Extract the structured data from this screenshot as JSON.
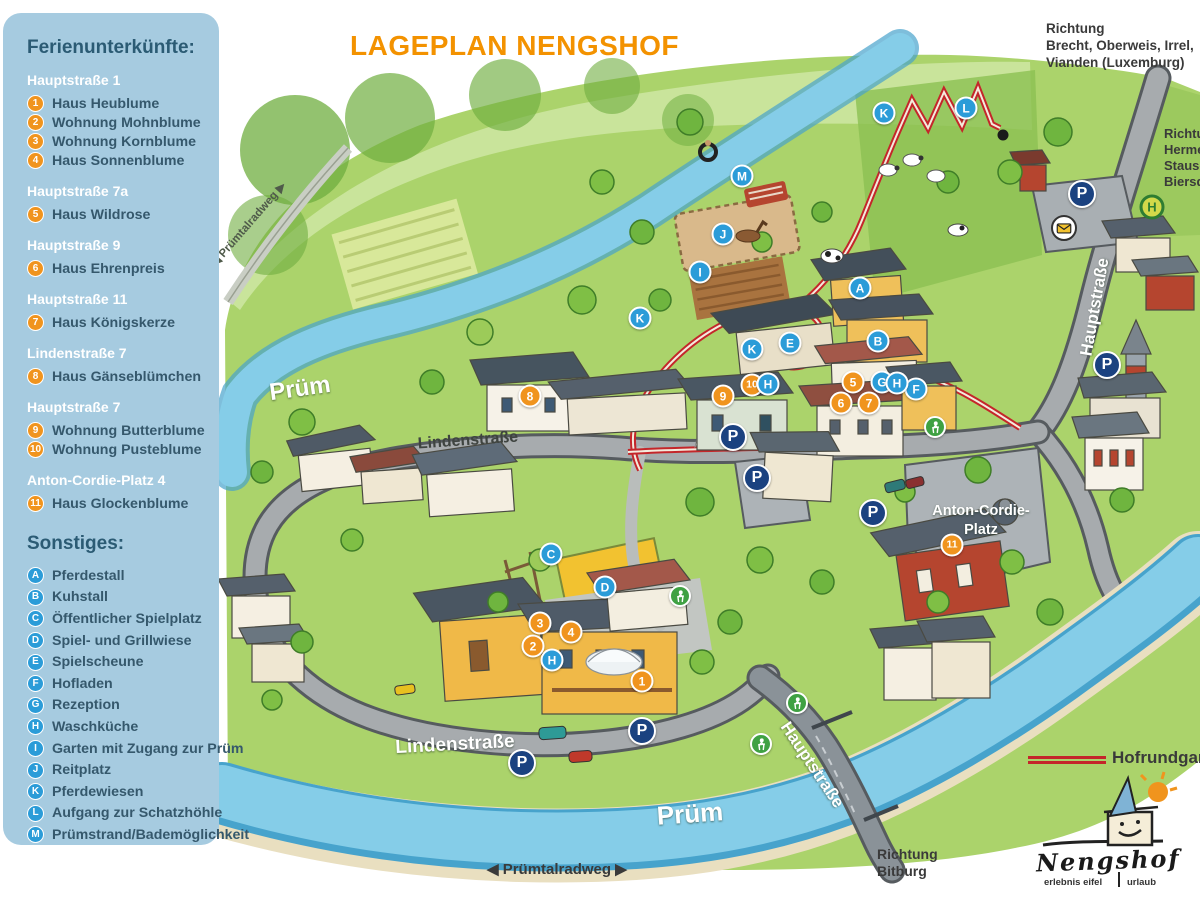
{
  "title": "LAGEPLAN NENGSHOF",
  "sidebar": {
    "title": "Ferienunterkünfte:",
    "groups": [
      {
        "street": "Hauptstraße 1",
        "items": [
          {
            "num": "1",
            "label": "Haus Heublume"
          },
          {
            "num": "2",
            "label": "Wohnung Mohnblume"
          },
          {
            "num": "3",
            "label": "Wohnung Kornblume"
          },
          {
            "num": "4",
            "label": "Haus Sonnenblume"
          }
        ]
      },
      {
        "street": "Hauptstraße 7a",
        "items": [
          {
            "num": "5",
            "label": "Haus Wildrose"
          }
        ]
      },
      {
        "street": "Hauptstraße 9",
        "items": [
          {
            "num": "6",
            "label": "Haus Ehrenpreis"
          }
        ]
      },
      {
        "street": "Hauptstraße 11",
        "items": [
          {
            "num": "7",
            "label": "Haus Königskerze"
          }
        ]
      },
      {
        "street": "Lindenstraße 7",
        "items": [
          {
            "num": "8",
            "label": "Haus Gänseblümchen"
          }
        ]
      },
      {
        "street": "Hauptstraße 7",
        "items": [
          {
            "num": "9",
            "label": "Wohnung Butterblume"
          },
          {
            "num": "10",
            "label": "Wohnung Pusteblume"
          }
        ]
      },
      {
        "street": "Anton-Cordie-Platz 4",
        "items": [
          {
            "num": "11",
            "label": "Haus Glockenblume"
          }
        ]
      }
    ],
    "other_title": "Sonstiges:",
    "others": [
      {
        "letter": "A",
        "label": "Pferdestall"
      },
      {
        "letter": "B",
        "label": "Kuhstall"
      },
      {
        "letter": "C",
        "label": "Öffentlicher Spielplatz"
      },
      {
        "letter": "D",
        "label": "Spiel- und Grillwiese"
      },
      {
        "letter": "E",
        "label": "Spielscheune"
      },
      {
        "letter": "F",
        "label": "Hofladen"
      },
      {
        "letter": "G",
        "label": "Rezeption"
      },
      {
        "letter": "H",
        "label": "Waschküche"
      },
      {
        "letter": "I",
        "label": "Garten mit Zugang zur Prüm"
      },
      {
        "letter": "J",
        "label": "Reitplatz"
      },
      {
        "letter": "K",
        "label": "Pferdewiesen"
      },
      {
        "letter": "L",
        "label": "Aufgang zur Schatzhöhle"
      },
      {
        "letter": "M",
        "label": "Prümstrand/Bademöglichkeit"
      }
    ]
  },
  "map": {
    "texts": {
      "direction_top_right": [
        "Richtung",
        "Brecht, Oberweis, Irrel,",
        "Vianden (Luxemburg)"
      ],
      "direction_right": [
        "Richtung",
        "Hermesdorf,",
        "Stausee,",
        "Biersdorf"
      ],
      "direction_bottom": [
        "Richtung",
        "Bitburg"
      ],
      "bike_path_bottom": "◀ Prümtalradweg ▶",
      "route_legend": "Hofrundgang",
      "logo_name": "Nengshof",
      "logo_tag_left": "erlebnis eifel",
      "logo_tag_right": "urlaub"
    },
    "labels": [
      {
        "text": "Prüm",
        "x": 300,
        "y": 389,
        "size": 24,
        "color": "#FFFFFF",
        "rotate": -8,
        "shadow": true
      },
      {
        "text": "Prüm",
        "x": 690,
        "y": 814,
        "size": 26,
        "color": "#FFFFFF",
        "rotate": -4,
        "shadow": true
      },
      {
        "text": "Lindenstraße",
        "x": 468,
        "y": 441,
        "size": 16,
        "color": "#3F4440",
        "rotate": -4,
        "shadow": false
      },
      {
        "text": "Lindenstraße",
        "x": 455,
        "y": 745,
        "size": 19,
        "color": "#FFFFFF",
        "rotate": -3,
        "shadow": true
      },
      {
        "text": "Hauptstraße",
        "x": 1095,
        "y": 307,
        "size": 17,
        "color": "#FFFFFF",
        "rotate": -80,
        "shadow": true
      },
      {
        "text": "Hauptstraße",
        "x": 812,
        "y": 765,
        "size": 17,
        "color": "#FFFFFF",
        "rotate": 56,
        "shadow": true
      },
      {
        "text": "Anton-Cordie-",
        "x": 981,
        "y": 511,
        "size": 14.5,
        "color": "#FFFFFF",
        "rotate": 0,
        "shadow": true
      },
      {
        "text": "Platz",
        "x": 981,
        "y": 530,
        "size": 14.5,
        "color": "#FFFFFF",
        "rotate": 0,
        "shadow": true
      },
      {
        "text": "◀ Prümtalradweg ▶",
        "x": 248,
        "y": 224,
        "size": 11.5,
        "color": "#4F5A4A",
        "rotate": -49,
        "shadow": false
      }
    ],
    "markers": [
      {
        "type": "num",
        "label": "1",
        "x": 642,
        "y": 681
      },
      {
        "type": "num",
        "label": "2",
        "x": 533,
        "y": 646
      },
      {
        "type": "num",
        "label": "3",
        "x": 540,
        "y": 623
      },
      {
        "type": "num",
        "label": "4",
        "x": 571,
        "y": 632
      },
      {
        "type": "num",
        "label": "5",
        "x": 853,
        "y": 382
      },
      {
        "type": "num",
        "label": "6",
        "x": 841,
        "y": 403
      },
      {
        "type": "num",
        "label": "7",
        "x": 869,
        "y": 403
      },
      {
        "type": "num",
        "label": "8",
        "x": 530,
        "y": 396
      },
      {
        "type": "num",
        "label": "9",
        "x": 723,
        "y": 396
      },
      {
        "type": "num",
        "label": "10",
        "x": 752,
        "y": 385
      },
      {
        "type": "num",
        "label": "11",
        "x": 952,
        "y": 545
      },
      {
        "type": "letter",
        "label": "A",
        "x": 860,
        "y": 288
      },
      {
        "type": "letter",
        "label": "B",
        "x": 878,
        "y": 341
      },
      {
        "type": "letter",
        "label": "C",
        "x": 551,
        "y": 554
      },
      {
        "type": "letter",
        "label": "D",
        "x": 605,
        "y": 587
      },
      {
        "type": "letter",
        "label": "E",
        "x": 790,
        "y": 343
      },
      {
        "type": "letter",
        "label": "F",
        "x": 916,
        "y": 389
      },
      {
        "type": "letter",
        "label": "G",
        "x": 882,
        "y": 382
      },
      {
        "type": "letter",
        "label": "H",
        "x": 897,
        "y": 383
      },
      {
        "type": "letter",
        "label": "H",
        "x": 768,
        "y": 384
      },
      {
        "type": "letter",
        "label": "H",
        "x": 552,
        "y": 660
      },
      {
        "type": "letter",
        "label": "I",
        "x": 700,
        "y": 272
      },
      {
        "type": "letter",
        "label": "J",
        "x": 723,
        "y": 234
      },
      {
        "type": "letter",
        "label": "K",
        "x": 884,
        "y": 113
      },
      {
        "type": "letter",
        "label": "K",
        "x": 752,
        "y": 349
      },
      {
        "type": "letter",
        "label": "K",
        "x": 640,
        "y": 318
      },
      {
        "type": "letter",
        "label": "L",
        "x": 966,
        "y": 108
      },
      {
        "type": "letter",
        "label": "M",
        "x": 742,
        "y": 176
      },
      {
        "type": "park",
        "label": "P",
        "x": 1082,
        "y": 194
      },
      {
        "type": "park",
        "label": "P",
        "x": 1107,
        "y": 365
      },
      {
        "type": "park",
        "label": "P",
        "x": 733,
        "y": 437
      },
      {
        "type": "park",
        "label": "P",
        "x": 757,
        "y": 478
      },
      {
        "type": "park",
        "label": "P",
        "x": 873,
        "y": 513
      },
      {
        "type": "park",
        "label": "P",
        "x": 642,
        "y": 731
      },
      {
        "type": "park",
        "label": "P",
        "x": 522,
        "y": 763
      },
      {
        "type": "ped",
        "name": "pedestrian-icon",
        "x": 935,
        "y": 427
      },
      {
        "type": "ped",
        "name": "pedestrian-icon",
        "x": 680,
        "y": 596
      },
      {
        "type": "ped",
        "name": "pedestrian-icon",
        "x": 797,
        "y": 703
      },
      {
        "type": "ped",
        "name": "pedestrian-icon",
        "x": 761,
        "y": 744
      },
      {
        "type": "post",
        "name": "postbox-icon",
        "x": 1064,
        "y": 228
      },
      {
        "type": "bus",
        "name": "bus-stop-icon",
        "label": "H",
        "x": 1152,
        "y": 207
      },
      {
        "type": "dot",
        "name": "cave-entrance-dot",
        "x": 1003,
        "y": 135
      }
    ],
    "colors": {
      "accent_orange": "#F0941E",
      "marker_blue": "#2B9CD8",
      "parking_navy": "#1B4280",
      "route_red": "#C4262A",
      "sidebar_bg": "#A6CBE0",
      "river_blue": "#85CDE8"
    }
  }
}
